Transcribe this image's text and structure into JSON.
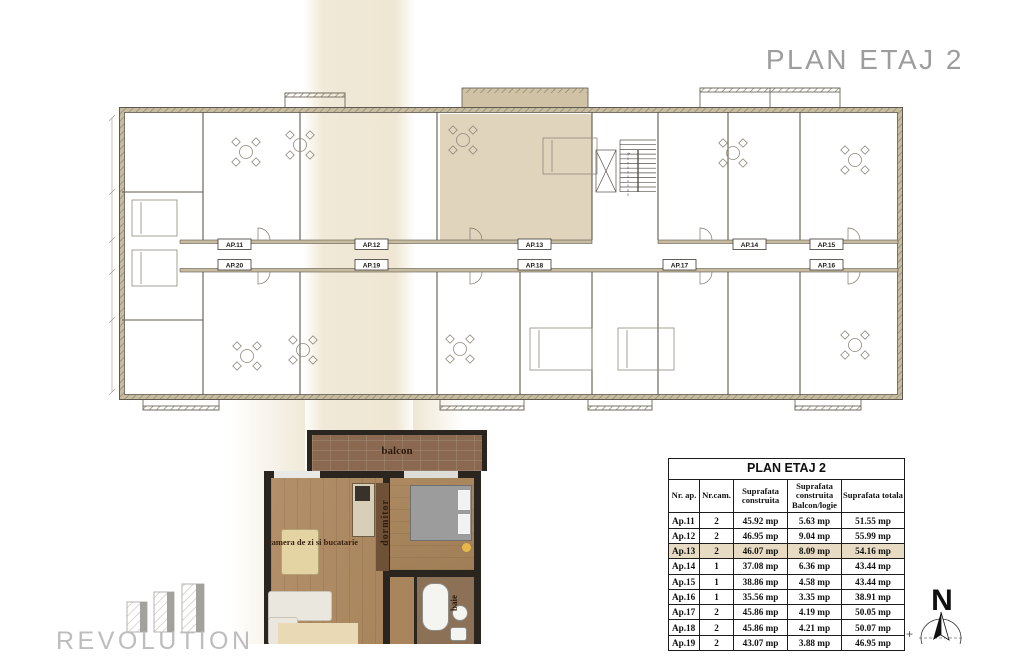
{
  "page": {
    "title": "PLAN ETAJ 2"
  },
  "colors": {
    "cream_band": "#f0e8d6",
    "plan_highlight": "#dacdb0",
    "table_highlight": "#e7dcc3",
    "balcony_brown": "#8a6950",
    "wood_floor": "#ad8a62",
    "title_gray": "#9d9d9d"
  },
  "plan": {
    "unit_labels_top": [
      "AP.11",
      "AP.12",
      "AP.13",
      "AP.14",
      "AP.15"
    ],
    "unit_labels_bottom": [
      "AP.20",
      "AP.19",
      "AP.18",
      "AP.17",
      "AP.16"
    ],
    "highlighted_unit": "AP.13"
  },
  "render3d": {
    "balcony_label": "balcon",
    "living_label": "camera de zi si bucatarie",
    "bedroom_label": "dormitor",
    "bath_label": "baie"
  },
  "table": {
    "title": "PLAN ETAJ 2",
    "columns": [
      "Nr. ap.",
      "Nr.cam.",
      "Suprafata construita",
      "Suprafata construita Balcon/logie",
      "Suprafata totala"
    ],
    "rows": [
      [
        "Ap.11",
        "2",
        "45.92 mp",
        "5.63 mp",
        "51.55 mp"
      ],
      [
        "Ap.12",
        "2",
        "46.95 mp",
        "9.04 mp",
        "55.99 mp"
      ],
      [
        "Ap.13",
        "2",
        "46.07 mp",
        "8.09 mp",
        "54.16 mp"
      ],
      [
        "Ap.14",
        "1",
        "37.08 mp",
        "6.36 mp",
        "43.44 mp"
      ],
      [
        "Ap.15",
        "1",
        "38.86 mp",
        "4.58 mp",
        "43.44 mp"
      ],
      [
        "Ap.16",
        "1",
        "35.56 mp",
        "3.35 mp",
        "38.91 mp"
      ],
      [
        "Ap.17",
        "2",
        "45.86 mp",
        "4.19 mp",
        "50.05 mp"
      ],
      [
        "Ap.18",
        "2",
        "45.86 mp",
        "4.21 mp",
        "50.07 mp"
      ],
      [
        "Ap.19",
        "2",
        "43.07 mp",
        "3.88 mp",
        "46.95 mp"
      ]
    ],
    "highlighted_row": "Ap.13"
  },
  "compass": {
    "north_label": "N"
  },
  "logo": {
    "text": "REVOLUTION"
  },
  "misc": {
    "crop_mark": "+"
  }
}
